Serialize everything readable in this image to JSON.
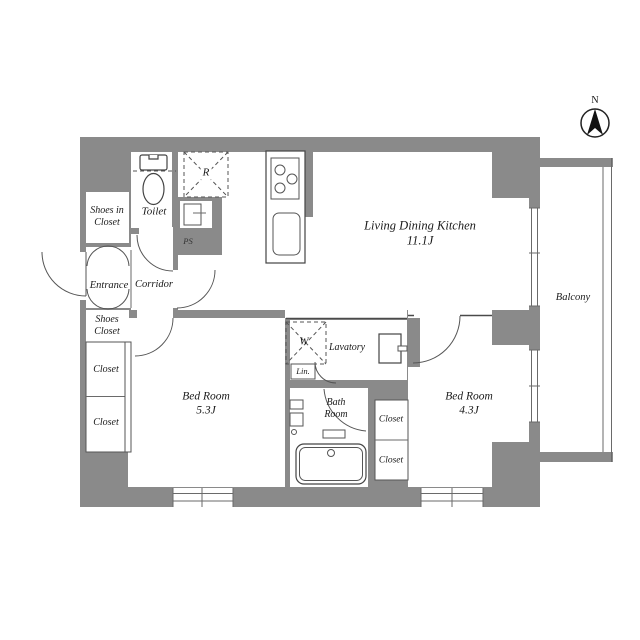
{
  "north": {
    "label": "N"
  },
  "rooms": {
    "ldk": {
      "name": "Living Dining Kitchen",
      "size": "11.1J"
    },
    "bedroom_5_3": {
      "name": "Bed Room",
      "size": "5.3J"
    },
    "bedroom_4_3": {
      "name": "Bed Room",
      "size": "4.3J"
    },
    "balcony": {
      "name": "Balcony"
    },
    "toilet": {
      "name": "Toilet"
    },
    "entrance": {
      "name": "Entrance"
    },
    "corridor": {
      "name": "Corridor"
    },
    "lavatory": {
      "name": "Lavatory"
    },
    "bathroom": {
      "line1": "Bath",
      "line2": "Room"
    },
    "shoes_in_closet": {
      "line1": "Shoes in",
      "line2": "Closet"
    },
    "shoes_closet": {
      "line1": "Shoes",
      "line2": "Closet"
    },
    "closet_left_top": {
      "name": "Closet"
    },
    "closet_left_bottom": {
      "name": "Closet"
    },
    "closet_mid_top": {
      "name": "Closet"
    },
    "closet_mid_bottom": {
      "name": "Closet"
    },
    "linen": {
      "name": "Lin."
    },
    "pipe_space": {
      "name": "PS"
    }
  },
  "symbols": {
    "washer": "W",
    "refrigerator": "R"
  },
  "colors": {
    "wall_gray": "#8a8a8a",
    "line": "#4a4a4a",
    "text": "#1a1a1a"
  }
}
